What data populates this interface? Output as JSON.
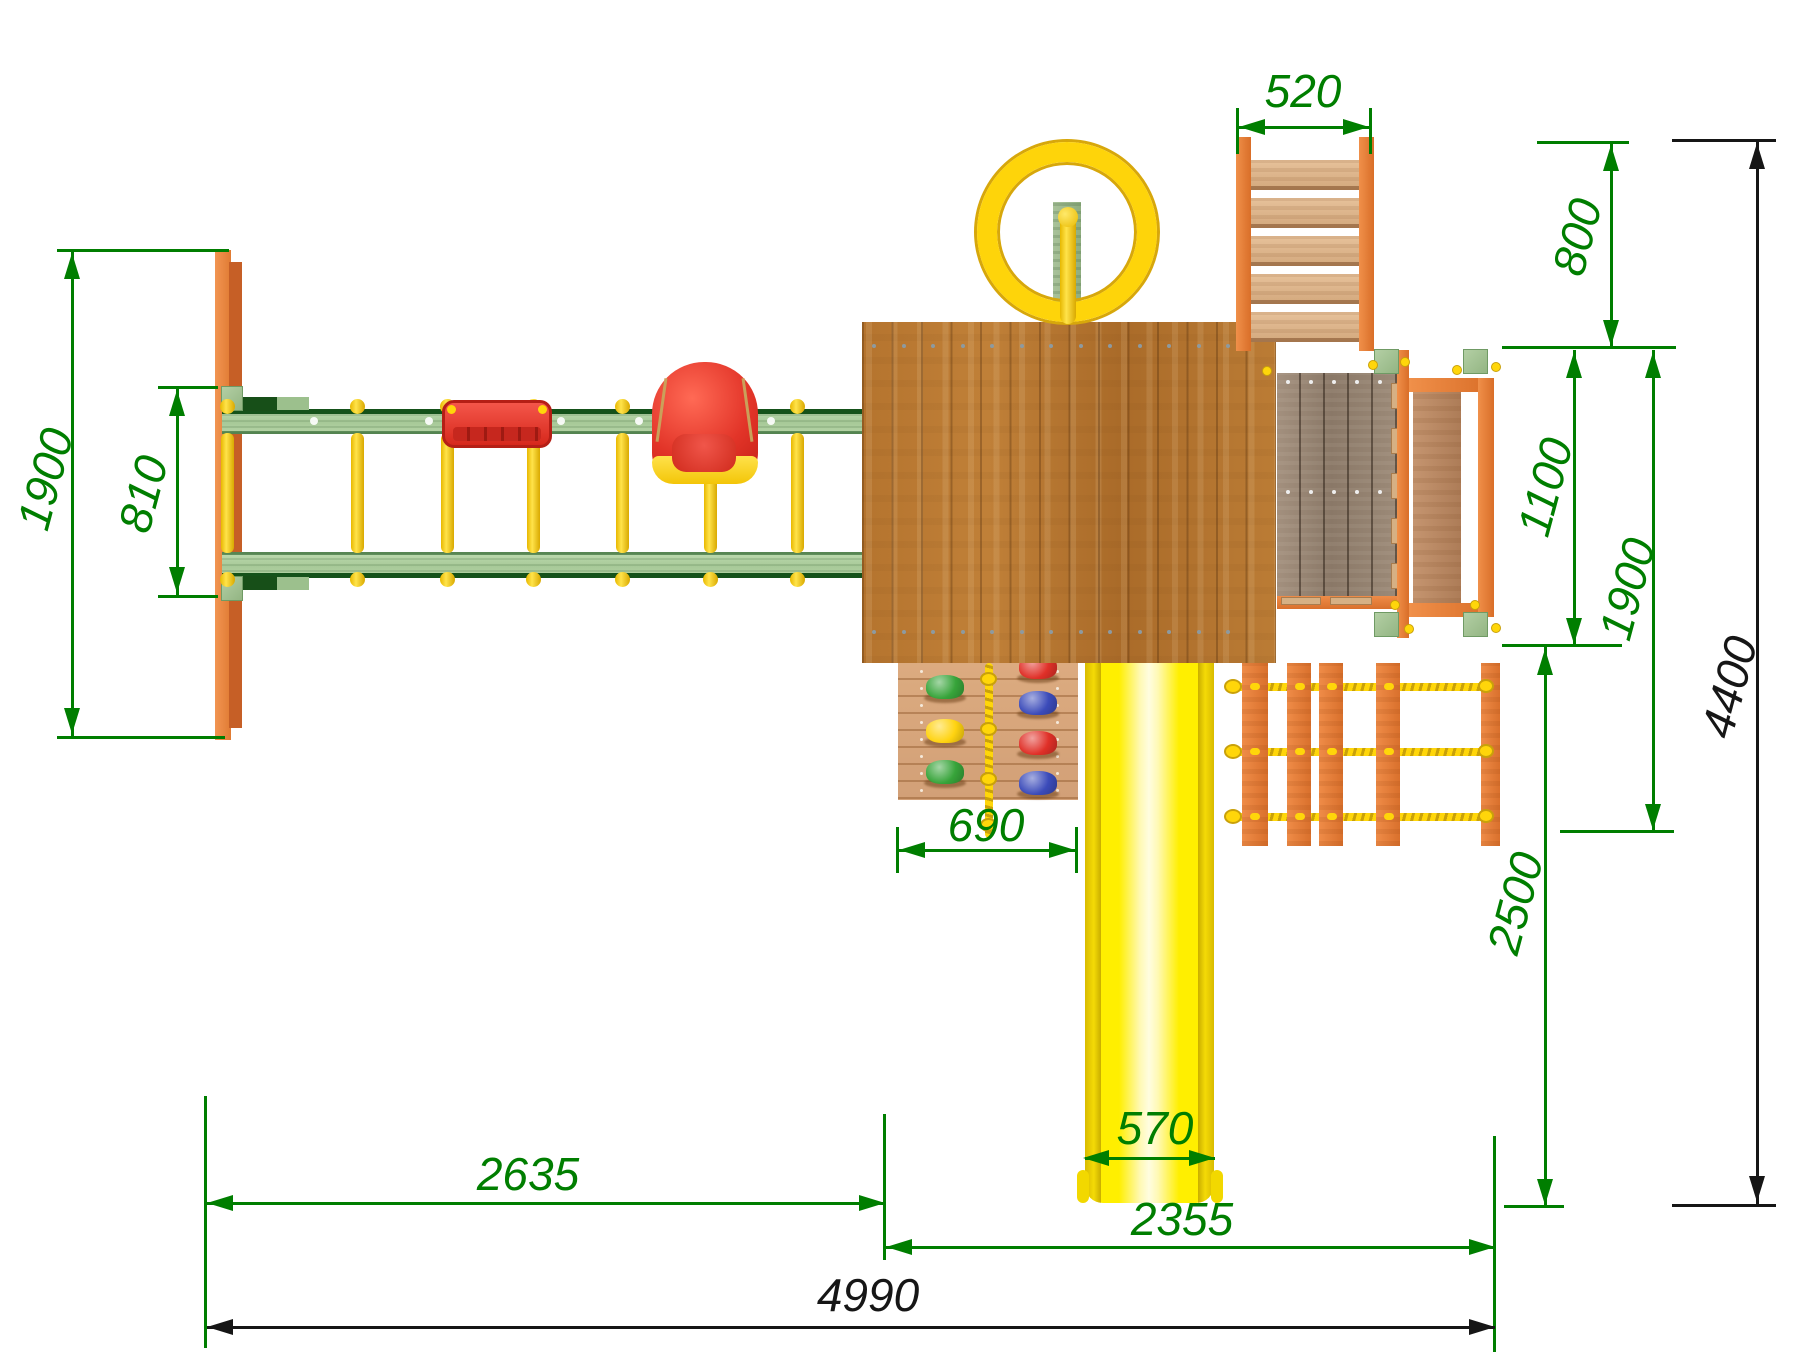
{
  "drawing_type": "playground-top-view-dimension-drawing",
  "dimensions": {
    "ladder_width": "520",
    "right_top_offset": "800",
    "swing_frame_depth": "1900",
    "swing_beam_gap": "810",
    "balcony_depth": "1100",
    "right_module_depth": "1900",
    "total_depth": "4400",
    "climbing_wall_width": "690",
    "slide_run_offset": "2500",
    "swing_section_length": "2635",
    "slide_width": "570",
    "tower_section_length": "2355",
    "total_length": "4990"
  },
  "palette": {
    "dimension_green": "#007e00",
    "dimension_black": "#161616",
    "orange_wood": "#e5803a",
    "green_wood": "#aecf9f",
    "dark_green": "#15521a",
    "roof_brown": "#b5742e",
    "deck_grey": "#9a8876",
    "balcony_plank": "#bd8d67",
    "yellow_plastic": "#ffd60a",
    "slide_yellow": "#ffef00",
    "seat_red": "#e23428"
  },
  "climbing_holds": {
    "left_column": [
      "green",
      "yellow",
      "green"
    ],
    "right_column": [
      "red",
      "blue",
      "red",
      "blue"
    ]
  },
  "hold_colors": {
    "green": "#37a43a",
    "yellow": "#ffd310",
    "red": "#e03028",
    "blue": "#3b4bba"
  }
}
